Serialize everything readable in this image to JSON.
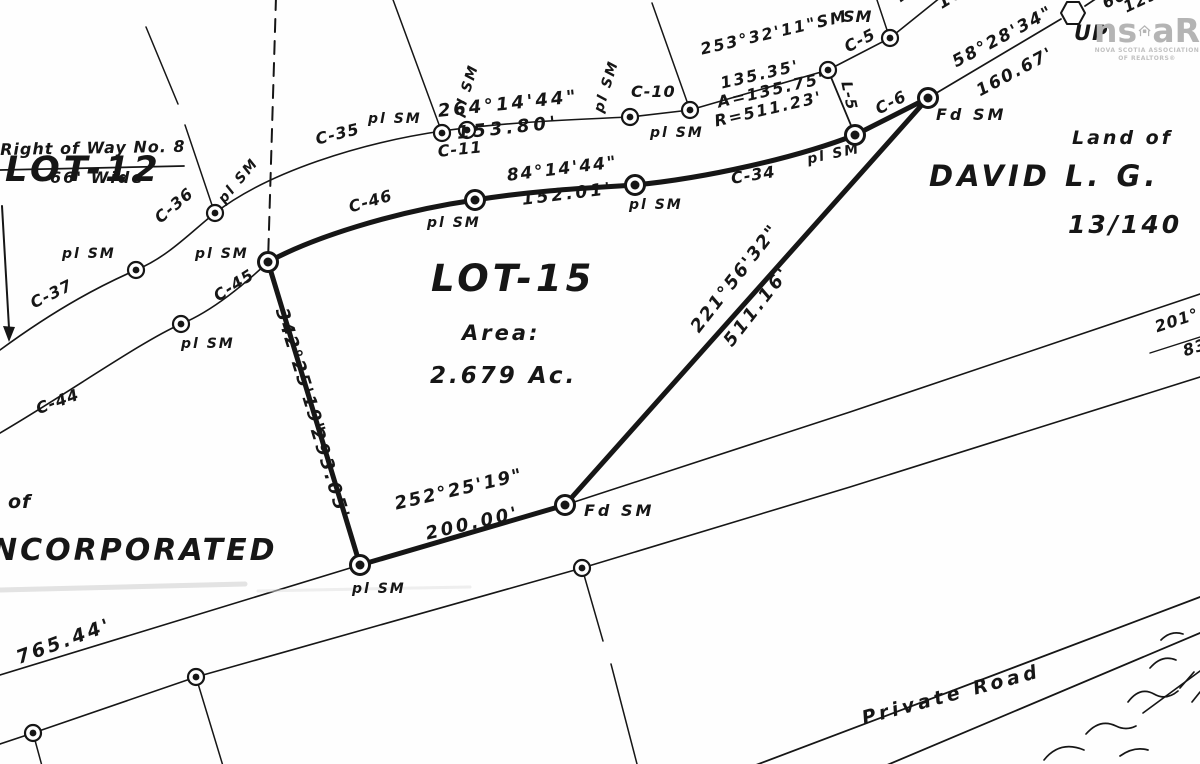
{
  "title": "Survey plan of LOT-15",
  "lot": {
    "name": "LOT-15",
    "area_label": "Area:",
    "area_value": "2.679 Ac."
  },
  "logo": {
    "prefix": "ns",
    "suffix": "aR",
    "tagline1": "NOVA SCOTIA ASSOCIATION",
    "tagline2": "OF REALTORS®",
    "color": "#b4b4b4"
  },
  "colors": {
    "ink": "#161616",
    "paper": "#fefefe",
    "logo_gray": "#b4b4b4"
  },
  "labels": [
    {
      "id": "lot12-label",
      "text": "LOT-12",
      "x": 5,
      "y": 152,
      "fs": 35,
      "ls": 4,
      "rot": 0,
      "cls": "big"
    },
    {
      "id": "lot13-label",
      "text": "LOT-13",
      "x": 196,
      "y": -34,
      "fs": 35,
      "ls": 4,
      "rot": 0,
      "cls": "big"
    },
    {
      "id": "right-of-way-label",
      "text": "Right of Way No. 8",
      "x": 0,
      "y": 142,
      "fs": 16,
      "ls": 1,
      "rot": -1
    },
    {
      "id": "right-of-way-width",
      "text": "66' Wide",
      "x": 50,
      "y": 170,
      "fs": 16,
      "ls": 2,
      "rot": 0
    },
    {
      "id": "pl-sm-1",
      "text": "pl SM",
      "x": 62,
      "y": 247,
      "fs": 14,
      "ls": 2,
      "rot": 0
    },
    {
      "id": "pl-sm-2",
      "text": "pl SM",
      "x": 216,
      "y": 197,
      "fs": 14,
      "ls": 2,
      "rot": -50
    },
    {
      "id": "pl-sm-3",
      "text": "pl SM",
      "x": 195,
      "y": 247,
      "fs": 14,
      "ls": 2,
      "rot": 0
    },
    {
      "id": "pl-sm-4",
      "text": "pl SM",
      "x": 181,
      "y": 337,
      "fs": 14,
      "ls": 2,
      "rot": 0
    },
    {
      "id": "pl-sm-5",
      "text": "pl SM",
      "x": 368,
      "y": 112,
      "fs": 14,
      "ls": 2,
      "rot": 0
    },
    {
      "id": "pl-sm-6",
      "text": "pl SM",
      "x": 452,
      "y": 114,
      "fs": 14,
      "ls": 2,
      "rot": -73
    },
    {
      "id": "pl-sm-7",
      "text": "pl SM",
      "x": 592,
      "y": 110,
      "fs": 14,
      "ls": 2,
      "rot": -73
    },
    {
      "id": "pl-sm-8",
      "text": "pl SM",
      "x": 650,
      "y": 126,
      "fs": 14,
      "ls": 2,
      "rot": 0
    },
    {
      "id": "pl-sm-9",
      "text": "pl SM",
      "x": 427,
      "y": 216,
      "fs": 14,
      "ls": 2,
      "rot": 0
    },
    {
      "id": "pl-sm-10",
      "text": "pl SM",
      "x": 629,
      "y": 198,
      "fs": 14,
      "ls": 2,
      "rot": 0
    },
    {
      "id": "pl-sm-11",
      "text": "pl SM",
      "x": 806,
      "y": 153,
      "fs": 14,
      "ls": 2,
      "rot": -12
    },
    {
      "id": "pl-sm-12",
      "text": "pl SM",
      "x": 352,
      "y": 582,
      "fs": 14,
      "ls": 2,
      "rot": 0
    },
    {
      "id": "fd-sm-1",
      "text": "Fd SM",
      "x": 936,
      "y": 107,
      "fs": 16,
      "ls": 3,
      "rot": 0
    },
    {
      "id": "fd-sm-2",
      "text": "Fd SM",
      "x": 584,
      "y": 503,
      "fs": 16,
      "ls": 3,
      "rot": 0
    },
    {
      "id": "sm-c5-label",
      "text": "SM",
      "x": 843,
      "y": 9,
      "fs": 16,
      "ls": 1,
      "rot": 0
    },
    {
      "id": "curve-c35",
      "text": "C-35",
      "x": 314,
      "y": 132,
      "fs": 16,
      "ls": 1,
      "rot": -14
    },
    {
      "id": "curve-c36",
      "text": "C-36",
      "x": 152,
      "y": 214,
      "fs": 16,
      "ls": 1,
      "rot": -40
    },
    {
      "id": "curve-c37",
      "text": "C-37",
      "x": 28,
      "y": 297,
      "fs": 16,
      "ls": 1,
      "rot": -26
    },
    {
      "id": "curve-c44",
      "text": "C-44",
      "x": 34,
      "y": 402,
      "fs": 16,
      "ls": 1,
      "rot": -20
    },
    {
      "id": "curve-c45",
      "text": "C-45",
      "x": 211,
      "y": 291,
      "fs": 16,
      "ls": 1,
      "rot": -33
    },
    {
      "id": "curve-c46",
      "text": "C-46",
      "x": 347,
      "y": 200,
      "fs": 16,
      "ls": 1,
      "rot": -16
    },
    {
      "id": "curve-c11",
      "text": "C-11",
      "x": 437,
      "y": 144,
      "fs": 16,
      "ls": 1,
      "rot": -6
    },
    {
      "id": "curve-c10",
      "text": "C-10",
      "x": 631,
      "y": 84,
      "fs": 16,
      "ls": 1,
      "rot": 0
    },
    {
      "id": "curve-c34",
      "text": "C-34",
      "x": 730,
      "y": 171,
      "fs": 16,
      "ls": 1,
      "rot": -9
    },
    {
      "id": "curve-c5",
      "text": "C-5",
      "x": 842,
      "y": 41,
      "fs": 16,
      "ls": 1,
      "rot": -27
    },
    {
      "id": "curve-c6",
      "text": "C-6",
      "x": 873,
      "y": 103,
      "fs": 16,
      "ls": 1,
      "rot": -27
    },
    {
      "id": "line-l5",
      "text": "L-5",
      "x": 853,
      "y": 80,
      "fs": 15,
      "ls": 1,
      "rot": 78
    },
    {
      "id": "bearing-264",
      "text": "264°14'44\"",
      "x": 437,
      "y": 103,
      "fs": 18,
      "ls": 3,
      "rot": -6
    },
    {
      "id": "dist-153-80",
      "text": "153.80'",
      "x": 456,
      "y": 125,
      "fs": 18,
      "ls": 4,
      "rot": -6
    },
    {
      "id": "bearing-84",
      "text": "84°14'44\"",
      "x": 506,
      "y": 168,
      "fs": 17,
      "ls": 2,
      "rot": -7
    },
    {
      "id": "dist-152-01",
      "text": "152.01'",
      "x": 521,
      "y": 192,
      "fs": 17,
      "ls": 3,
      "rot": -7
    },
    {
      "id": "bearing-253",
      "text": "253°32'11\"SM",
      "x": 699,
      "y": 42,
      "fs": 16,
      "ls": 2,
      "rot": -13
    },
    {
      "id": "dist-135-35",
      "text": "135.35'",
      "x": 719,
      "y": 76,
      "fs": 16,
      "ls": 2,
      "rot": -13
    },
    {
      "id": "arc-length",
      "text": "A=135.75'",
      "x": 716,
      "y": 95,
      "fs": 16,
      "ls": 2,
      "rot": -13
    },
    {
      "id": "arc-radius",
      "text": "R=511.23'",
      "x": 713,
      "y": 114,
      "fs": 16,
      "ls": 2,
      "rot": -13
    },
    {
      "id": "bearing-58",
      "text": "58°28'34\"",
      "x": 950,
      "y": 56,
      "fs": 17,
      "ls": 2,
      "rot": -28
    },
    {
      "id": "dist-160-67",
      "text": "160.67'",
      "x": 974,
      "y": 85,
      "fs": 17,
      "ls": 2,
      "rot": -28
    },
    {
      "id": "bearing-230",
      "text": "230°",
      "x": 893,
      "y": -8,
      "fs": 17,
      "ls": 2,
      "rot": -36
    },
    {
      "id": "dist-161-9",
      "text": "161.9'",
      "x": 935,
      "y": -2,
      "fs": 17,
      "ls": 2,
      "rot": -31
    },
    {
      "id": "dist-66",
      "text": "66'",
      "x": 1100,
      "y": -3,
      "fs": 16,
      "ls": 1,
      "rot": -25
    },
    {
      "id": "dist-129-82",
      "text": "129.82",
      "x": 1121,
      "y": 1,
      "fs": 16,
      "ls": 1,
      "rot": -25
    },
    {
      "id": "utility-pole-label",
      "text": "UP",
      "x": 1074,
      "y": 22,
      "fs": 21,
      "ls": 1,
      "rot": 0,
      "cls": "big"
    },
    {
      "id": "bearing-221",
      "text": "221°56'32\"",
      "x": 688,
      "y": 325,
      "fs": 18,
      "ls": 2,
      "rot": -52
    },
    {
      "id": "dist-511-16",
      "text": "511.16'",
      "x": 721,
      "y": 339,
      "fs": 18,
      "ls": 3,
      "rot": -52
    },
    {
      "id": "bearing-342",
      "text": "342°25'19\"",
      "x": 289,
      "y": 306,
      "fs": 18,
      "ls": 2,
      "rot": 73
    },
    {
      "id": "dist-293-05",
      "text": "293.05'",
      "x": 324,
      "y": 426,
      "fs": 18,
      "ls": 3,
      "rot": 73
    },
    {
      "id": "bearing-252",
      "text": "252°25'19\"",
      "x": 393,
      "y": 496,
      "fs": 18,
      "ls": 2,
      "rot": -13
    },
    {
      "id": "dist-200-00",
      "text": "200.00'",
      "x": 424,
      "y": 526,
      "fs": 18,
      "ls": 3,
      "rot": -13
    },
    {
      "id": "dist-765-44",
      "text": "765.44'",
      "x": 14,
      "y": 650,
      "fs": 19,
      "ls": 3,
      "rot": -20
    },
    {
      "id": "bearing-201",
      "text": "201°",
      "x": 1153,
      "y": 320,
      "fs": 16,
      "ls": 1,
      "rot": -18
    },
    {
      "id": "dist-83",
      "text": "83",
      "x": 1181,
      "y": 344,
      "fs": 16,
      "ls": 1,
      "rot": -18
    },
    {
      "id": "adjoiner-land-of",
      "text": "Land of",
      "x": 1072,
      "y": 129,
      "fs": 19,
      "ls": 3,
      "rot": 0
    },
    {
      "id": "adjoiner-owner",
      "text": "DAVID L. G.",
      "x": 929,
      "y": 161,
      "fs": 29,
      "ls": 4,
      "rot": 0,
      "cls": "big"
    },
    {
      "id": "adjoiner-deed",
      "text": "13/140",
      "x": 1068,
      "y": 212,
      "fs": 25,
      "ls": 3,
      "rot": 0
    },
    {
      "id": "lot15-label",
      "text": "LOT-15",
      "x": 431,
      "y": 260,
      "fs": 37,
      "ls": 4,
      "rot": 0,
      "cls": "big"
    },
    {
      "id": "lot15-area-label",
      "text": "Area:",
      "x": 462,
      "y": 322,
      "fs": 21,
      "ls": 3,
      "rot": 0
    },
    {
      "id": "lot15-area-value",
      "text": "2.679 Ac.",
      "x": 430,
      "y": 364,
      "fs": 23,
      "ls": 3,
      "rot": 0
    },
    {
      "id": "private-road-label",
      "text": "Private Road",
      "x": 860,
      "y": 710,
      "fs": 19,
      "ls": 4,
      "rot": -15
    },
    {
      "id": "owner-of-label",
      "text": "of",
      "x": 8,
      "y": 493,
      "fs": 19,
      "ls": 1,
      "rot": 0
    },
    {
      "id": "owner-incorporated",
      "text": "NCORPORATED",
      "x": -8,
      "y": 535,
      "fs": 30,
      "ls": 3,
      "rot": 0,
      "cls": "big"
    }
  ],
  "monuments": [
    {
      "x": 136,
      "y": 270,
      "size": "r"
    },
    {
      "x": 215,
      "y": 213,
      "size": "r"
    },
    {
      "x": 442,
      "y": 133,
      "size": "r"
    },
    {
      "x": 467,
      "y": 130,
      "size": "r"
    },
    {
      "x": 630,
      "y": 117,
      "size": "r"
    },
    {
      "x": 690,
      "y": 110,
      "size": "r"
    },
    {
      "x": 828,
      "y": 70,
      "size": "r"
    },
    {
      "x": 890,
      "y": 38,
      "size": "r"
    },
    {
      "x": 181,
      "y": 324,
      "size": "r"
    },
    {
      "x": 268,
      "y": 262,
      "size": "b"
    },
    {
      "x": 475,
      "y": 200,
      "size": "b"
    },
    {
      "x": 635,
      "y": 185,
      "size": "b"
    },
    {
      "x": 855,
      "y": 135,
      "size": "b"
    },
    {
      "x": 928,
      "y": 98,
      "size": "b"
    },
    {
      "x": 565,
      "y": 505,
      "size": "b"
    },
    {
      "x": 360,
      "y": 565,
      "size": "b"
    },
    {
      "x": 33,
      "y": 733,
      "size": "r"
    },
    {
      "x": 196,
      "y": 677,
      "size": "r"
    },
    {
      "x": 582,
      "y": 568,
      "size": "r"
    }
  ]
}
